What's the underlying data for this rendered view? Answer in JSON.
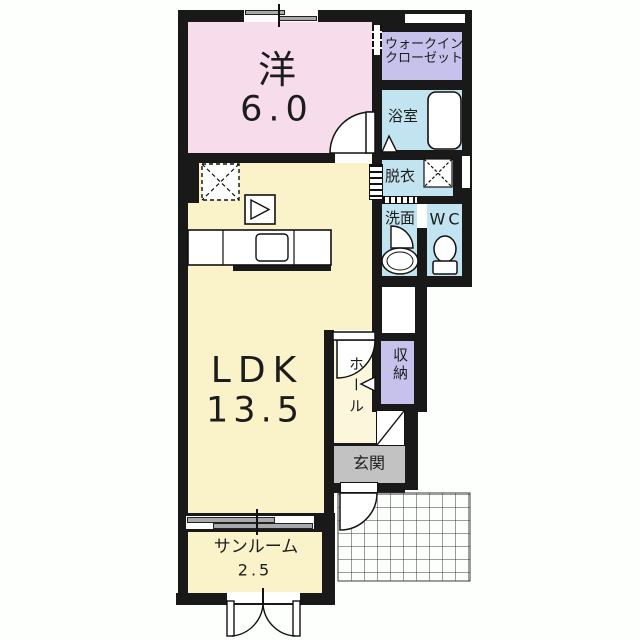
{
  "labels": {
    "western_room_name": "洋",
    "western_room_size": "6.0",
    "wic_line1": "ウォークイン",
    "wic_line2": "クローゼット",
    "bathroom": "浴室",
    "dressing_room": "脱衣",
    "washroom": "洗面",
    "toilet": "WC",
    "ldk_name": "LDK",
    "ldk_size": "13.5",
    "hall": "ホール",
    "storage": "収納",
    "entrance": "玄関",
    "sunroom_name": "サンルーム",
    "sunroom_size": "2.5"
  },
  "colors": {
    "wall": "#191919",
    "western_room": "#f7dcec",
    "closet": "#c6c2ec",
    "wet_area": "#c2e3f0",
    "ldk": "#faf3ca",
    "hall": "#fbf6dc",
    "entrance": "#c2c2c2",
    "background": "#ffffff"
  }
}
